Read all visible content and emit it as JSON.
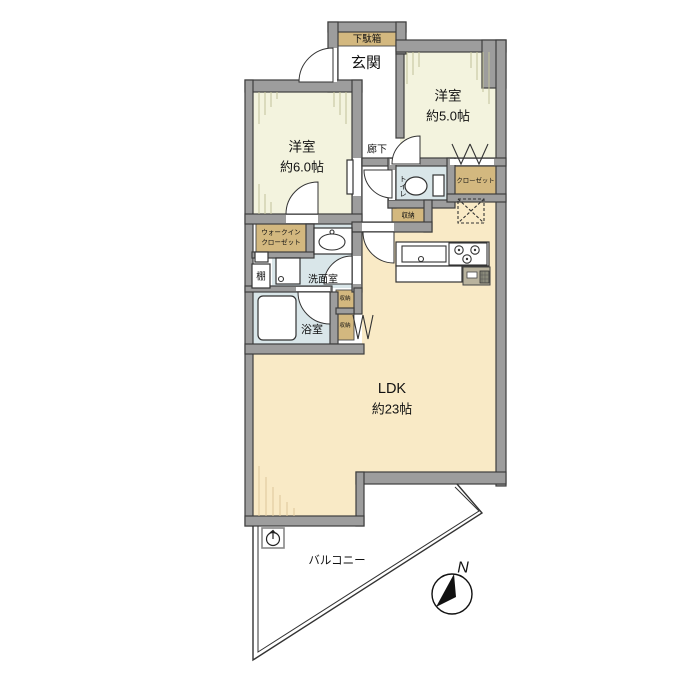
{
  "floorplan": {
    "rooms": {
      "genkan": {
        "label": "玄関"
      },
      "getabako": {
        "label": "下駄箱"
      },
      "bedroom5": {
        "label": "洋室",
        "size": "約5.0帖"
      },
      "bedroom6": {
        "label": "洋室",
        "size": "約6.0帖"
      },
      "corridor": {
        "label": "廊下"
      },
      "toilet": {
        "label": "トイレ"
      },
      "closet": {
        "label": "クローゼット"
      },
      "storage_hall": {
        "label": "収納"
      },
      "storage_upper": {
        "label": "収納"
      },
      "storage_lower": {
        "label": "収納"
      },
      "wic": {
        "line1": "ウォークイン",
        "line2": "クローゼット"
      },
      "washroom": {
        "label": "洗面室"
      },
      "shelf": {
        "label": "棚"
      },
      "bathroom": {
        "label": "浴室"
      },
      "ldk": {
        "label": "LDK",
        "size": "約23帖"
      },
      "balcony": {
        "label": "バルコニー"
      }
    },
    "compass": {
      "north_label": "N"
    },
    "colors": {
      "wall": "#9d9d9d",
      "wall_outline": "#3e3e3e",
      "bedroom_floor": "#f3f3de",
      "ldk_floor": "#f9eac6",
      "wet_area_floor": "#d9e6e9",
      "closet_fill": "#d3b87f"
    }
  }
}
